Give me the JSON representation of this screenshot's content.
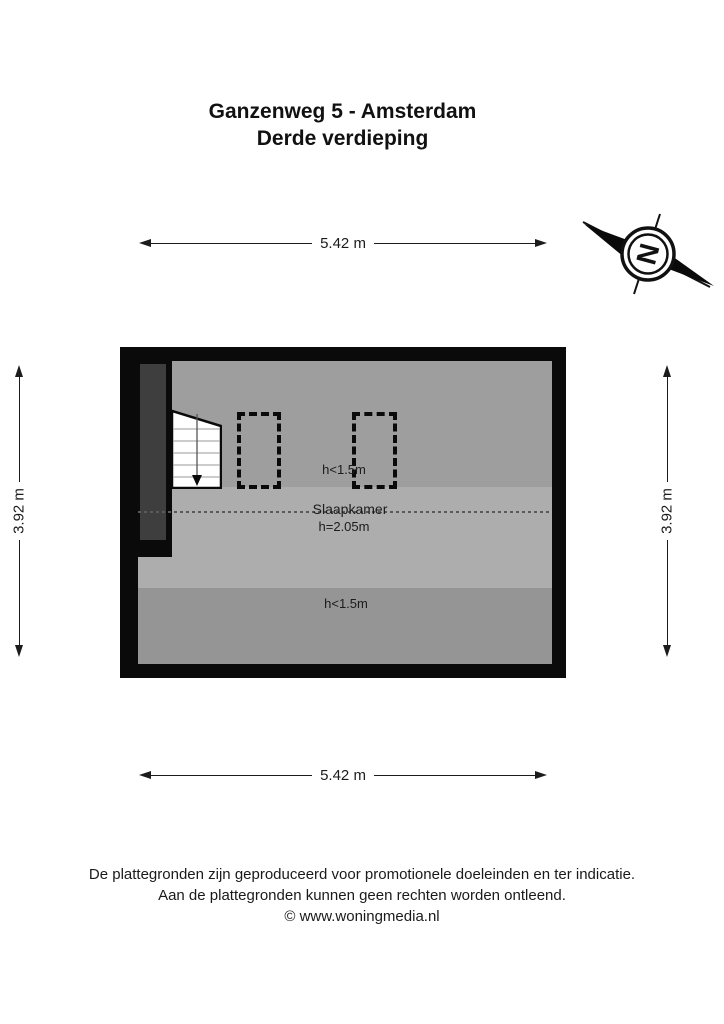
{
  "title": {
    "line1": "Ganzenweg 5 - Amsterdam",
    "line2": "Derde verdieping"
  },
  "compass": {
    "north_label": "N"
  },
  "dimensions": {
    "width_top": "5.42 m",
    "width_bottom": "5.42 m",
    "height_left": "3.92 m",
    "height_right": "3.92 m"
  },
  "floorplan": {
    "room_label": "Slaapkamer",
    "ceiling_zones": {
      "top": "h<1.5m",
      "middle": "h=2.05m",
      "bottom": "h<1.5m"
    }
  },
  "footer": {
    "line1": "De plattegronden zijn geproduceerd voor promotionele doeleinden en ter indicatie.",
    "line2": "Aan de plattegronden kunnen geen rechten worden ontleend.",
    "line3": "© www.woningmedia.nl"
  },
  "colors": {
    "wall": "#0a0a0a",
    "floor_low_top": "#9e9e9e",
    "floor_high": "#adadad",
    "floor_low_bottom": "#959595",
    "shaft": "#3e3e3e",
    "ink": "#1c1c1c"
  }
}
